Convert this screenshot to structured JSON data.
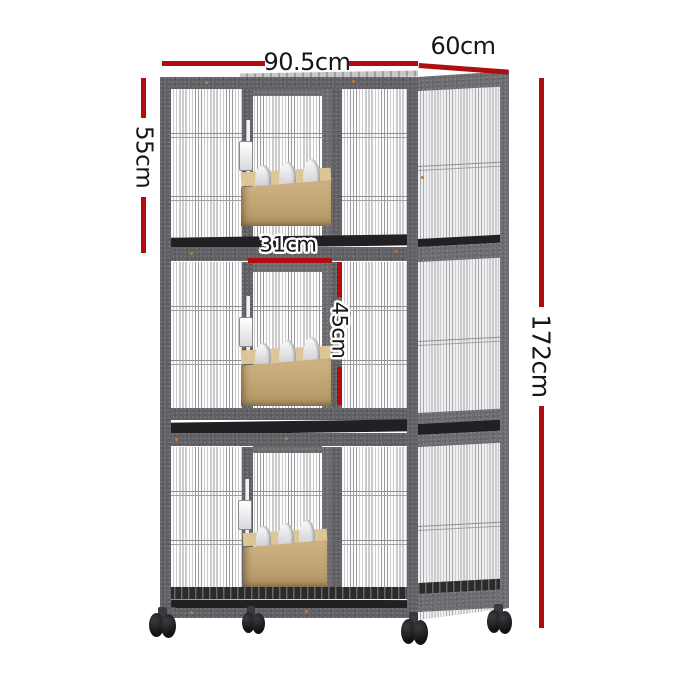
{
  "image": {
    "type": "product-dimension-diagram",
    "subject": "Three-tier wire pet breeding cage on caster wheels with feeder boxes"
  },
  "dimensions": {
    "front_width": {
      "label": "90.5cm"
    },
    "depth": {
      "label": "60cm"
    },
    "tier_height": {
      "label": "55cm"
    },
    "door_width": {
      "label": "31cm"
    },
    "door_height": {
      "label": "45cm"
    },
    "total_height": {
      "label": "172cm"
    }
  },
  "colors": {
    "annotation_red": "#b00d11",
    "label_text": "#161616",
    "frame_grey": "#616165",
    "tray_black": "#212123",
    "feeder_tan": "#c0a572",
    "background": "#ffffff"
  }
}
